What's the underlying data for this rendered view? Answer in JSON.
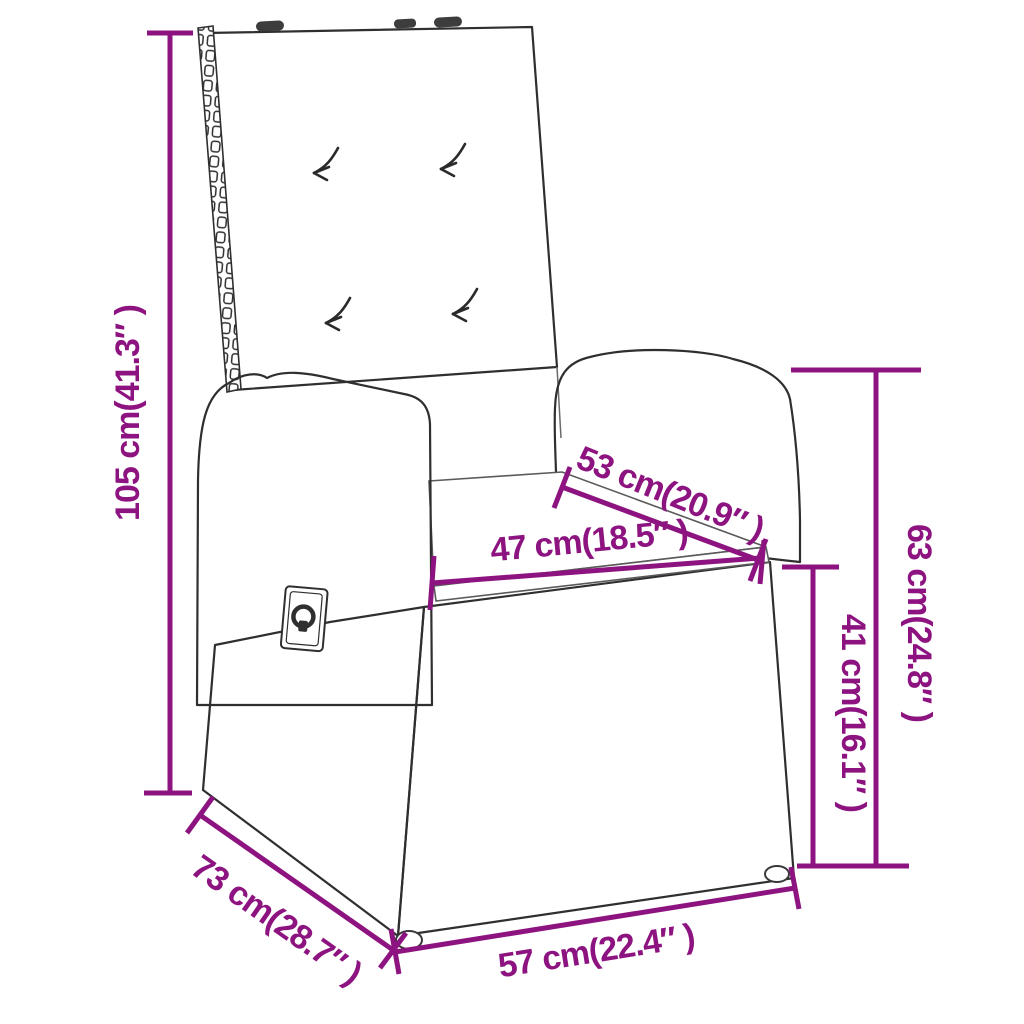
{
  "diagram": {
    "kind": "product-dimension-diagram",
    "subject": "reclining rattan garden chair with cushions",
    "background_color": "#FFFFFF",
    "accent_color": "#8D1480",
    "outline_color": "#2F2F2F"
  },
  "dimensions": {
    "total_height": {
      "label": "105 cm(41.3″ )",
      "cm": 105,
      "inches": 41.3
    },
    "armrest_height": {
      "label": "63 cm(24.8″ )",
      "cm": 63,
      "inches": 24.8
    },
    "seat_height": {
      "label": "41 cm(16.1″ )",
      "cm": 41,
      "inches": 16.1
    },
    "seat_depth": {
      "label": "53 cm(20.9″ )",
      "cm": 53,
      "inches": 20.9
    },
    "seat_width": {
      "label": "47 cm(18.5″ )",
      "cm": 47,
      "inches": 18.5
    },
    "total_depth": {
      "label": "73 cm(28.7″ )",
      "cm": 73,
      "inches": 28.7
    },
    "total_width": {
      "label": "57 cm(22.4″ )",
      "cm": 57,
      "inches": 22.4
    }
  }
}
